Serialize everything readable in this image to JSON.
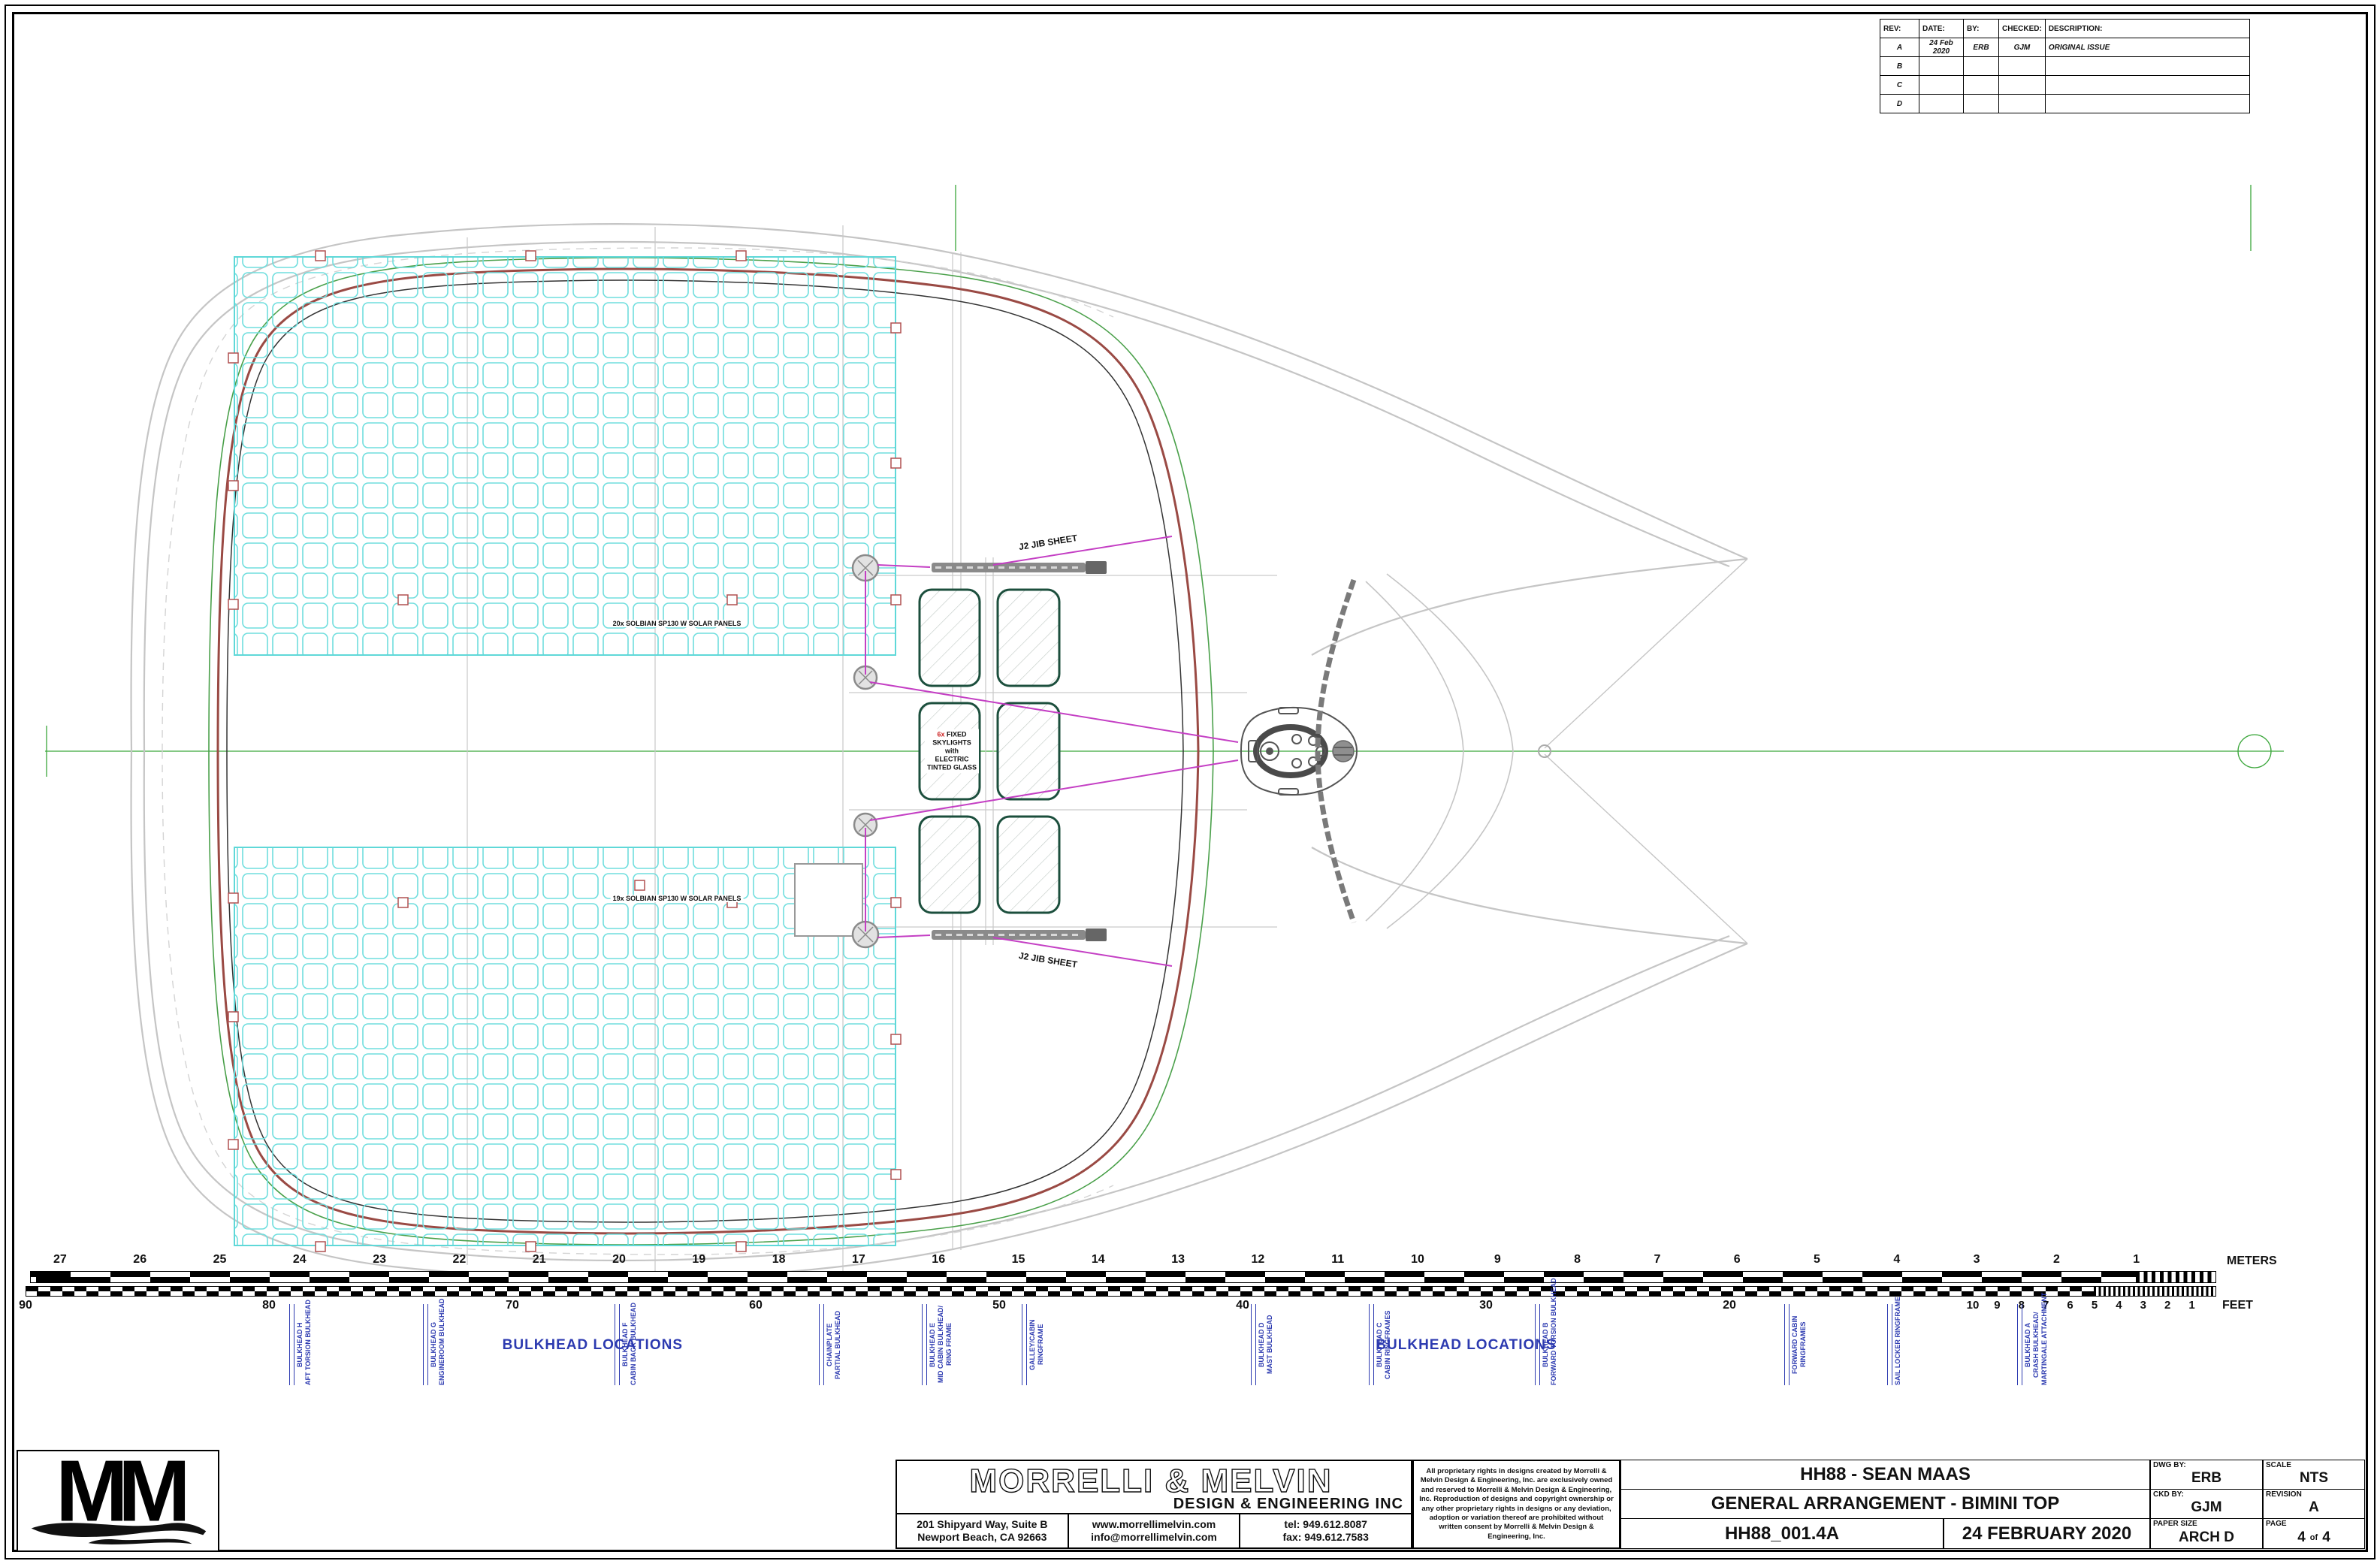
{
  "revision_table": {
    "headers": [
      "REV:",
      "DATE:",
      "BY:",
      "CHECKED:",
      "DESCRIPTION:"
    ],
    "rows": [
      [
        "A",
        "24 Feb 2020",
        "ERB",
        "GJM",
        "ORIGINAL ISSUE"
      ],
      [
        "B",
        "",
        "",
        "",
        ""
      ],
      [
        "C",
        "",
        "",
        "",
        ""
      ],
      [
        "D",
        "",
        "",
        "",
        ""
      ]
    ]
  },
  "drawing": {
    "solar_label_top": "20x SOLBIAN SP130 W SOLAR PANELS",
    "solar_label_bottom": "19x SOLBIAN SP130 W SOLAR PANELS",
    "skylight_count": "6x",
    "skylight_line1_rest": " FIXED",
    "skylight_lines": [
      "SKYLIGHTS",
      "with",
      "ELECTRIC",
      "TINTED GLASS"
    ],
    "jib_sheet_label_top": "J2 JIB SHEET",
    "jib_sheet_label_bottom": "J2 JIB SHEET"
  },
  "scale_bar": {
    "meters_ticks": [
      27,
      26,
      25,
      24,
      23,
      22,
      21,
      20,
      19,
      18,
      17,
      16,
      15,
      14,
      13,
      12,
      11,
      10,
      9,
      8,
      7,
      6,
      5,
      4,
      3,
      2,
      1
    ],
    "meters_unit": "METERS",
    "feet_ticks_major": [
      90,
      80,
      70,
      60,
      50,
      40,
      30,
      20
    ],
    "feet_ticks_minor": [
      10,
      9,
      8,
      7,
      6,
      5,
      4,
      3,
      2,
      1
    ],
    "feet_unit": "FEET"
  },
  "bulkheads": {
    "section_label_left": "BULKHEAD LOCATIONS",
    "section_label_right": "BULKHEAD LOCATIONS",
    "items": [
      {
        "x_pct": 12.15,
        "lines": [
          "BULKHEAD H",
          "AFT TORSION BULKHEAD"
        ]
      },
      {
        "x_pct": 17.77,
        "lines": [
          "BULKHEAD G",
          "ENGINEROOM BULKHEAD"
        ]
      },
      {
        "x_pct": 25.82,
        "lines": [
          "BULKHEAD F",
          "CABIN BACK BULKHEAD"
        ]
      },
      {
        "x_pct": 34.41,
        "lines": [
          "CHAINPLATE",
          "PARTIAL BULKHEAD"
        ]
      },
      {
        "x_pct": 38.73,
        "lines": [
          "BULKHEAD E",
          "MID CABIN BULKHEAD/",
          "RING FRAME"
        ]
      },
      {
        "x_pct": 42.93,
        "lines": [
          "GALLEY/CABIN",
          "RINGFRAME"
        ]
      },
      {
        "x_pct": 52.56,
        "lines": [
          "BULKHEAD D",
          "MAST BULKHEAD"
        ]
      },
      {
        "x_pct": 57.51,
        "lines": [
          "BULKHEAD C",
          "CABIN RINGFRAMES"
        ]
      },
      {
        "x_pct": 64.49,
        "lines": [
          "BULKHEAD B",
          "FORWARD TORSION BULKHEAD"
        ]
      },
      {
        "x_pct": 74.97,
        "lines": [
          "FORWARD CABIN",
          "RINGFRAMES"
        ]
      },
      {
        "x_pct": 79.29,
        "lines": [
          "SAIL LOCKER RINGFRAME"
        ]
      },
      {
        "x_pct": 84.75,
        "lines": [
          "BULKHEAD A",
          "CRASH BULKHEAD/",
          "MARTINGALE ATTACHMENT"
        ]
      }
    ]
  },
  "title_block": {
    "company": "MORRELLI & MELVIN",
    "company_sub": "DESIGN & ENGINEERING INC",
    "address_line1": "201 Shipyard Way, Suite B",
    "address_line2": "Newport Beach, CA  92663",
    "web": "www.morrellimelvin.com",
    "email": "info@morrellimelvin.com",
    "tel": "tel: 949.612.8087",
    "fax": "fax: 949.612.7583",
    "legal": "All proprietary rights in designs created by Morrelli & Melvin Design & Engineering, Inc. are exclusively owned and reserved to Morrelli & Melvin Design & Engineering, Inc. Reproduction of designs and copyright ownership or any other proprietary rights in designs or any deviation, adoption or variation thereof are prohibited without written consent by Morrelli & Melvin Design & Engineering, Inc.",
    "project": "HH88 - SEAN MAAS",
    "drawing_title": "GENERAL ARRANGEMENT - BIMINI TOP",
    "drawing_number": "HH88_001.4A",
    "date": "24 FEBRUARY 2020",
    "dwg_by_label": "DWG BY:",
    "dwg_by": "ERB",
    "ckd_by_label": "CKD BY:",
    "ckd_by": "GJM",
    "scale_label": "SCALE",
    "scale": "NTS",
    "revision_label": "REVISION",
    "revision": "A",
    "paper_size_label": "PAPER SIZE",
    "paper_size": "ARCH D",
    "page_label": "PAGE",
    "page": "4",
    "page_of": "of",
    "page_total": "4"
  },
  "logo": {
    "text": "MM"
  },
  "colors": {
    "annotation_blue": "#2c3ab0",
    "solar_cyan": "#5fd8d8",
    "sheet_magenta": "#c43fc4",
    "reference_green": "#3aa63a",
    "coachroof_red": "#9a4a44",
    "skylight_green": "#1c4f3d"
  }
}
